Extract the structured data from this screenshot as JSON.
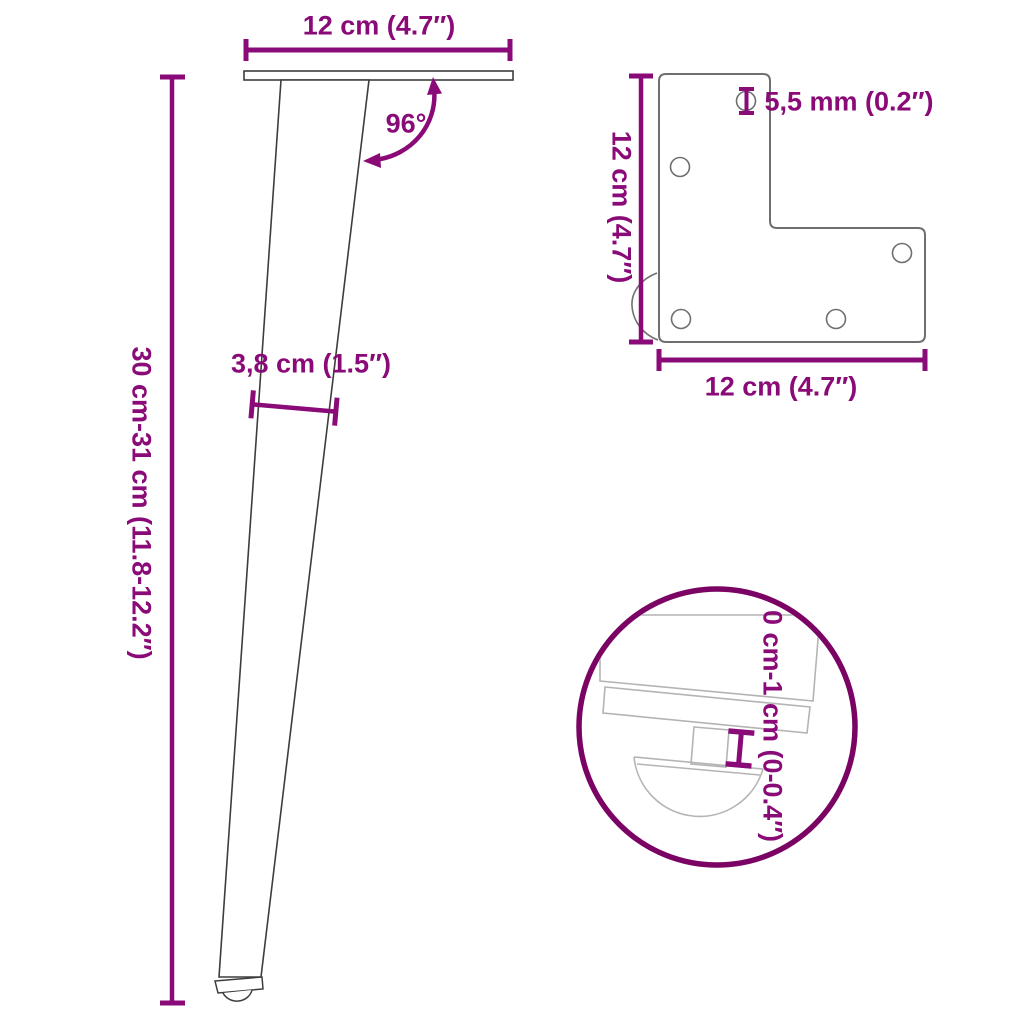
{
  "title": "furniture-leg-dimension-diagram",
  "colors": {
    "accent": "#8A0A78",
    "accent-dark": "#7A0363",
    "outline": "#3D3D3D",
    "plate": "#6F6F6F",
    "detail": "#B4B4B4"
  },
  "leg_view": {
    "top_width_label": "12 cm (4.7″)",
    "angle_label": "96°",
    "height_label": "30 cm-31 cm (11.8-12.2″)",
    "thickness_label": "3,8 cm (1.5″)"
  },
  "plate_view": {
    "hole_diameter_label": "5,5 mm (0.2″)",
    "hole_diameter_icon": "diameter-symbol",
    "height_label": "12 cm (4.7″)",
    "width_label": "12 cm (4.7″)",
    "hole_count": 5
  },
  "detail_view": {
    "adjust_range_label": "0 cm-1 cm (0-0.4″)"
  }
}
